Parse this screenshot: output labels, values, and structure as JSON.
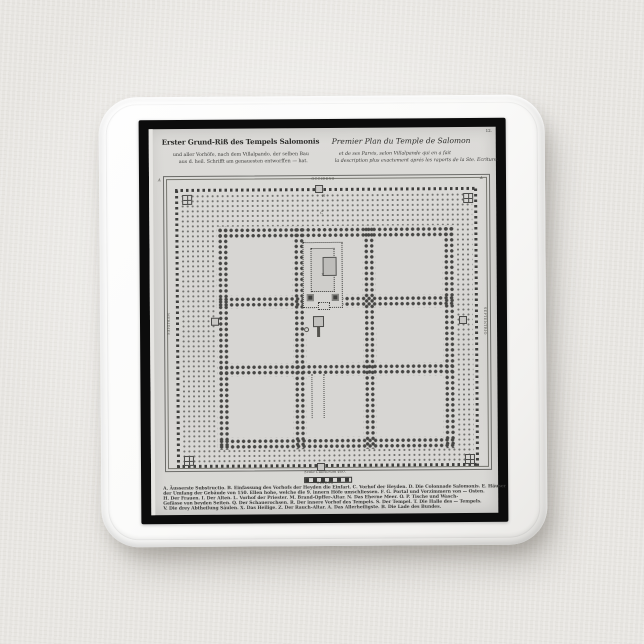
{
  "scene": {
    "background_color": "#e7e5e1",
    "button_color": "#f9f8f7",
    "print_frame_color": "#0c0c0c",
    "paper_color": "#d8d7d4",
    "ink_color": "#3c3c3a"
  },
  "print": {
    "page_number": "12.",
    "title_german": {
      "line1": "Erster Grund-Riß des Tempels Salomonis",
      "line2": "und aller Vorhöfe, nach dem Villalpando, der selben Bau",
      "line3": "aus d. heil. Schrifft am genauesten entworffen — hat."
    },
    "title_french": {
      "line1": "Premier Plan du Temple de Salomon",
      "line2": "et de ses Parvis, selon Villalpande qui en a fait",
      "line3": "la description plus exactement aprés les raports de la Ste. Ecriture."
    },
    "compass": {
      "top": "OCCIDENS",
      "bottom": "ORIENS",
      "left": "MERIDIES",
      "right": "SEPTENTRIO"
    },
    "scale_caption": "Scala Cubitorum 400.",
    "temple_mark": "X",
    "plan_letters": [
      "A",
      "B",
      "C",
      "D",
      "C",
      "A"
    ],
    "legend_lines": [
      "A. Äusserste Substructio. B. Einfassung des Vorhofs der Heyden die Einfart. C. Vorhof der Heyden. D. Die Colonnade Salomonis. E. Häuser",
      "der Umfang der Gebäude von 150. Ellen hohe, welche die 9. innern Höfe umschliessen. F. G. Portal und Vorzimmern von — Osten.",
      "H. Der Frauen. I. Der Alten. L. Vorhof der Priester. M. Brand-Opffer-Altar. N. Das Eherne Meer. O. P. Tische und Wasch-",
      "Gefässe von beyden Seiten. Q. Der Schauerochsen. R. Der innere Vorhof des Tempels. S. Der Tempel. T. Die Halle des — Tempels.",
      "V. Die drey Abtheilung Säulen. X. Das Heilige. Z. Der Rauch-Altar. A. Das Allerheiligste. B. Die Lade des Bundes."
    ]
  }
}
